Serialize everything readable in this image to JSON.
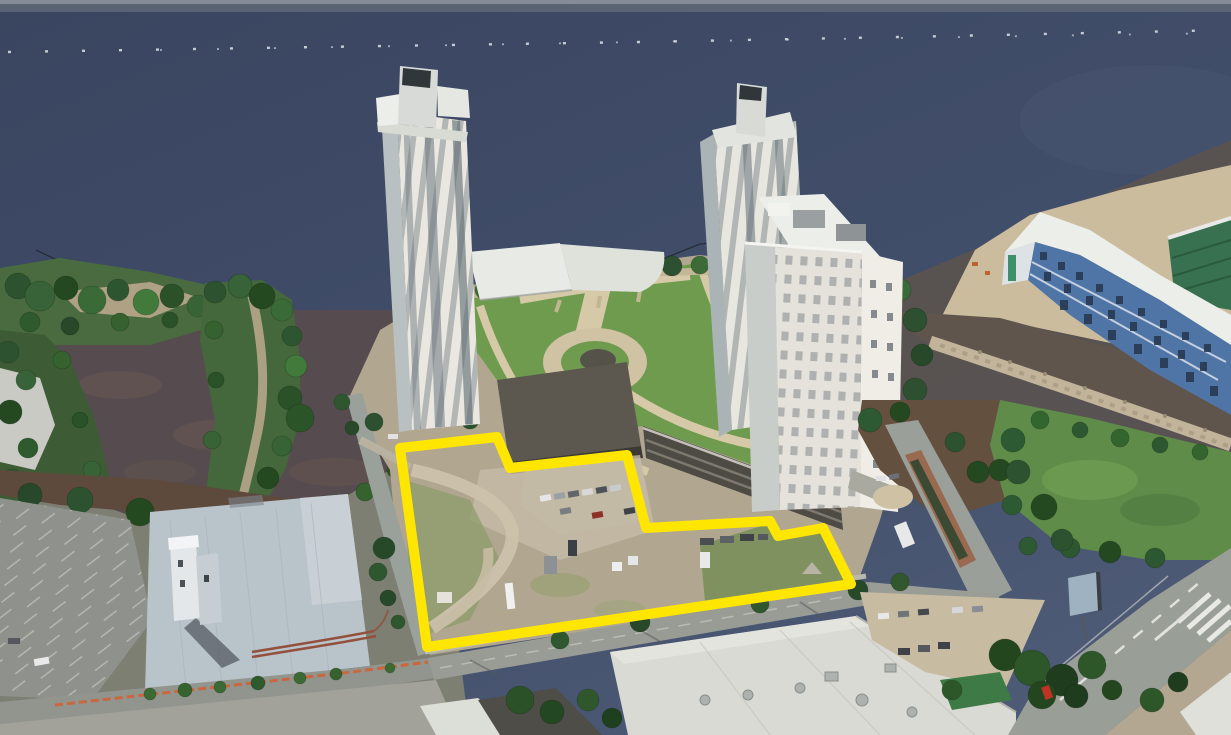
{
  "view": {
    "type": "oblique-3d-aerial-satellite-imagery",
    "description": "Waterfront riverfront site: two tall residential towers and one mid-rise tower around an elevated lawn park with radial paths, a parking garage podium, and a vacant dirt development parcel outlined in yellow; industrial warehouse lower-left, building under construction upper-right, boulevard lower-right."
  },
  "colors": {
    "water_deep": "#3d4861",
    "water_shallow_murk": "#574d4e",
    "parcel_outline": "#ffe600",
    "lawn_green": "#6f9b4e",
    "field_green": "#5f8c49",
    "dirt_lot": "#b1a690",
    "tree_dark": "#2c5230",
    "roof_light": "#d9dad3",
    "industrial_roof": "#b9c3ca",
    "construction_blue": "#4f74a6",
    "construction_green_panels": "#37714f",
    "road_gray": "#999c94",
    "riprap_tan": "#c2b49a",
    "garage_dark": "#4e4b44",
    "barrier_orange": "#cf6236"
  },
  "parcel": {
    "outline_points": "400,448 497,437 510,468 627,455 646,528 770,521 778,536 823,528 851,584 427,647",
    "stroke_color": "#ffe600",
    "stroke_width": "10"
  },
  "landmarks": [
    "river-water",
    "buoy-line",
    "wooded-peninsulas",
    "left-tower",
    "rear-right-tower",
    "front-tower",
    "central-lawn-park",
    "parking-garage-podium",
    "outlined-vacant-parcel",
    "industrial-warehouse",
    "surface-parking-lot",
    "construction-midrise",
    "green-field",
    "boulevard-with-crosswalk",
    "warehouse-rooftops",
    "billboard"
  ]
}
